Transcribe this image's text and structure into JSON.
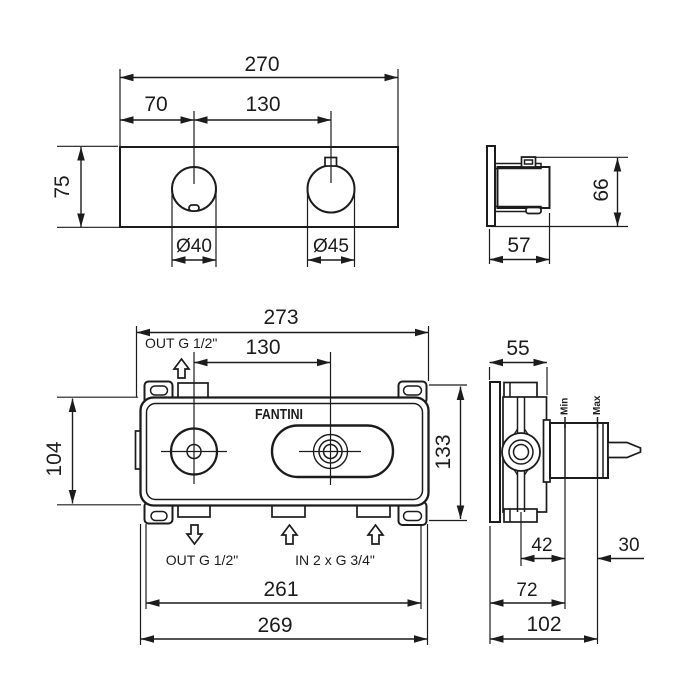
{
  "brand": "FANTINI",
  "trim_front": {
    "width": "270",
    "hole_offset": "70",
    "hole_spacing": "130",
    "height": "75",
    "dia_left": "Ø40",
    "dia_right": "Ø45"
  },
  "trim_side": {
    "height": "66",
    "depth": "57"
  },
  "roughin_front": {
    "width": "273",
    "hole_spacing": "130",
    "body_height": "104",
    "overall_height": "133",
    "body_width": "261",
    "overall_width": "269",
    "outlet_top": "OUT G 1/2\"",
    "outlet_bottom": "OUT G 1/2\"",
    "inlets": "IN 2 x G 3/4\""
  },
  "roughin_side": {
    "depth": "55",
    "plaster_min": "42",
    "stem_len": "30",
    "depth_min": "72",
    "depth_max": "102",
    "min_label": "Min",
    "max_label": "Max"
  }
}
